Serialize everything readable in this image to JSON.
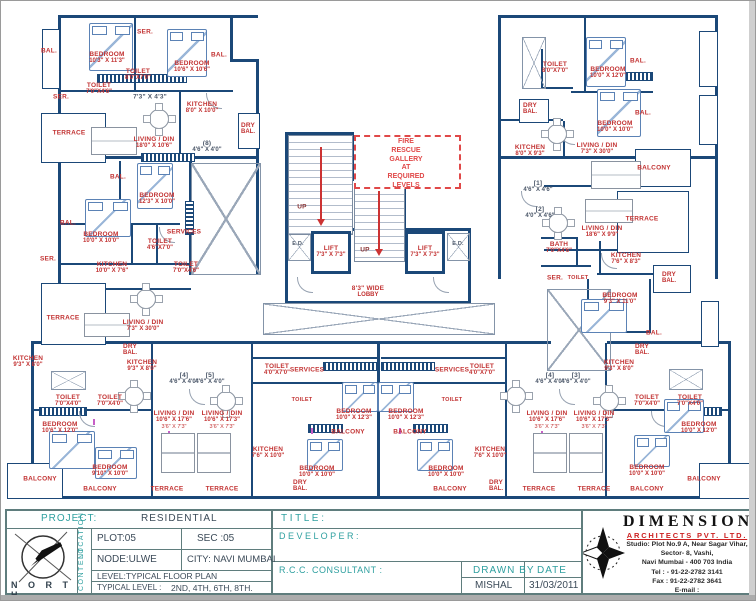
{
  "title_block": {
    "project_label": "PROJECT:",
    "project_value": "RESIDENTIAL",
    "plot": "PLOT:05",
    "sec": "SEC :05",
    "node": "NODE:ULWE",
    "city": "CITY: NAVI MUMBAI",
    "level_label": "LEVEL:",
    "level_value": "TYPICAL FLOOR PLAN",
    "typical_label": "TYPICAL LEVEL :",
    "typical_value": "2ND, 4TH, 6TH, 8TH.",
    "location_strip": "LOCATION",
    "content_strip": "CONTENT",
    "north_label": "N O R T H",
    "title_label": "T I T L E :",
    "developer_label": "D E V E L O P E R :",
    "rcc_label": "R.C.C. CONSULTANT :",
    "drawn_by_label": "DRAWN BY",
    "drawn_by_value": "MISHAL",
    "date_label": "DATE",
    "date_value": "31/03/2011"
  },
  "company": {
    "name": "DIMENSIONS",
    "subtitle": "ARCHITECTS PVT. LTD.",
    "address_lines": [
      "Studio: Plot No.9 A, Near Sagar Vihar,",
      "Sector- 8, Vashi,",
      "Navi Mumbai - 400 703 India",
      "Tel : - 91-22-2782 3141",
      "Fax : 91-22-2782 3641",
      "E-mail : info@dimensionsarchitect.co.in",
      "Website : dimensionsarchitect.co.in"
    ]
  },
  "plan": {
    "fire_rescue": "FIRE\nRESCUE\nGALLERY\nAT\nREQUIRED\nLEVELS",
    "colors": {
      "wall": "#1b4878",
      "label_red": "#c23232",
      "dashed_red": "#e04848"
    },
    "labels": [
      {
        "t": "BAL.",
        "x": 48,
        "y": 50
      },
      {
        "t": "BEDROOM",
        "d": "10'3\" X 11'3\"",
        "x": 106,
        "y": 57
      },
      {
        "t": "SER.",
        "x": 144,
        "y": 31
      },
      {
        "t": "TOILET",
        "d": "8'0\"X7'0\"",
        "x": 137,
        "y": 74
      },
      {
        "t": "BEDROOM",
        "d": "10'6\" X 10'6\"",
        "x": 191,
        "y": 66
      },
      {
        "t": "BAL.",
        "x": 218,
        "y": 54
      },
      {
        "t": "SER.",
        "x": 60,
        "y": 96
      },
      {
        "t": "TOILET",
        "d": "7'0\"X4'6\"",
        "x": 98,
        "y": 88
      },
      {
        "t": "7'3\" X 4'3\"",
        "x": 149,
        "y": 96,
        "c": "dark"
      },
      {
        "t": "KITCHEN",
        "d": "8'0\" X 10'0\"",
        "x": 201,
        "y": 107
      },
      {
        "t": "DRY",
        "d": "BAL.",
        "x": 247,
        "y": 128
      },
      {
        "t": "TERRACE",
        "x": 68,
        "y": 132
      },
      {
        "t": "LIVING / DIN",
        "d": "18'0\" X 10'6\"",
        "x": 153,
        "y": 142
      },
      {
        "t": "(8)",
        "d": "4'6\" X 4'0\"",
        "x": 206,
        "y": 146,
        "c": "dark"
      },
      {
        "t": "BAL.",
        "x": 117,
        "y": 176
      },
      {
        "t": "BEDROOM",
        "d": "12'3\" X 10'0\"",
        "x": 156,
        "y": 198
      },
      {
        "t": "BAL.",
        "x": 67,
        "y": 222
      },
      {
        "t": "BEDROOM",
        "d": "10'0\" X 10'0\"",
        "x": 100,
        "y": 237
      },
      {
        "t": "SERVICES",
        "x": 183,
        "y": 231
      },
      {
        "t": "TOILET",
        "d": "4'6\"X7'0\"",
        "x": 159,
        "y": 244
      },
      {
        "t": "TOILET",
        "d": "7'0\"X4'6\"",
        "x": 185,
        "y": 267
      },
      {
        "t": "KITCHEN",
        "d": "10'0\" X 7'6\"",
        "x": 111,
        "y": 267
      },
      {
        "t": "SER.",
        "x": 47,
        "y": 258
      },
      {
        "t": "TERRACE",
        "x": 62,
        "y": 317
      },
      {
        "t": "LIVING / DIN",
        "d": "7'3\" X 30'0\"",
        "x": 142,
        "y": 325
      },
      {
        "t": "UP",
        "x": 301,
        "y": 206,
        "c": "up"
      },
      {
        "t": "UP",
        "x": 364,
        "y": 249,
        "c": "up"
      },
      {
        "t": "E.D.",
        "x": 297,
        "y": 243,
        "c": "dark",
        "fs": 5.5
      },
      {
        "t": "LIFT",
        "d": "7'3\" X 7'3\"",
        "x": 330,
        "y": 251
      },
      {
        "t": "LIFT",
        "d": "7'3\" X 7'3\"",
        "x": 424,
        "y": 251
      },
      {
        "t": "E.D.",
        "x": 457,
        "y": 243,
        "c": "dark",
        "fs": 5.5
      },
      {
        "t": "8'3\" WIDE",
        "d": "LOBBY",
        "x": 367,
        "y": 291
      },
      {
        "t": "TOILET",
        "d": "8'0\"X7'0\"",
        "x": 554,
        "y": 67
      },
      {
        "t": "BEDROOM",
        "d": "10'0\" X 12'0\"",
        "x": 607,
        "y": 72
      },
      {
        "t": "BAL.",
        "x": 637,
        "y": 60
      },
      {
        "t": "DRY",
        "d": "BAL.",
        "x": 529,
        "y": 108
      },
      {
        "t": "BEDROOM",
        "d": "10'0\" X 10'0\"",
        "x": 614,
        "y": 126
      },
      {
        "t": "BAL.",
        "x": 642,
        "y": 112
      },
      {
        "t": "KITCHEN",
        "d": "8'0\" X 9'3\"",
        "x": 529,
        "y": 150
      },
      {
        "t": "LIVING / DIN",
        "d": "7'3\" X 30'0\"",
        "x": 596,
        "y": 148
      },
      {
        "t": "BALCONY",
        "x": 653,
        "y": 167
      },
      {
        "t": "[1]",
        "d": "4'6\" X 4'6\"",
        "x": 537,
        "y": 186,
        "c": "dark"
      },
      {
        "t": "[2]",
        "d": "4'0\" X 4'6\"",
        "x": 539,
        "y": 212,
        "c": "dark"
      },
      {
        "t": "TERRACE",
        "x": 641,
        "y": 218
      },
      {
        "t": "LIVING / DIN",
        "d": "18'6\" X 9'9\"",
        "x": 601,
        "y": 231
      },
      {
        "t": "BATH",
        "d": "7'0\"X4'6\"",
        "x": 558,
        "y": 247
      },
      {
        "t": "KITCHEN",
        "d": "7'6\" X 8'3\"",
        "x": 625,
        "y": 258
      },
      {
        "t": "SER.",
        "x": 554,
        "y": 277
      },
      {
        "t": "TOILET",
        "x": 577,
        "y": 277,
        "fs": 5.5
      },
      {
        "t": "DRY",
        "d": "BAL.",
        "x": 668,
        "y": 277
      },
      {
        "t": "BEDROOM",
        "d": "9'3\" X 11'0\"",
        "x": 619,
        "y": 298
      },
      {
        "t": "BAL.",
        "x": 653,
        "y": 332
      },
      {
        "t": "KITCHEN",
        "d": "9'3\" X 8'0\"",
        "x": 27,
        "y": 361
      },
      {
        "t": "DRY",
        "d": "BAL.",
        "x": 129,
        "y": 349
      },
      {
        "t": "KITCHEN",
        "d": "9'3\" X 8'0\"",
        "x": 141,
        "y": 365
      },
      {
        "t": "[4]",
        "d": "4'6\" X 4'0\"",
        "x": 183,
        "y": 378,
        "c": "dark"
      },
      {
        "t": "[5]",
        "d": "4'6\" X 4'0\"",
        "x": 209,
        "y": 378,
        "c": "dark"
      },
      {
        "t": "TOILET",
        "d": "7'0\"X4'0\"",
        "x": 67,
        "y": 400
      },
      {
        "t": "TOILET",
        "d": "7'0\"X4'0\"",
        "x": 109,
        "y": 400
      },
      {
        "t": "BEDROOM",
        "d": "10'6\" X 12'0\"",
        "x": 59,
        "y": 427
      },
      {
        "t": "BEDROOM",
        "d": "9'10\" X 10'0\"",
        "x": 109,
        "y": 470
      },
      {
        "t": "BALCONY",
        "x": 39,
        "y": 478
      },
      {
        "t": "BALCONY",
        "x": 99,
        "y": 488
      },
      {
        "t": "LIVING / DIN",
        "d": "10'6\" X 17'6\"",
        "d2": "3'6\" X 7'3\"",
        "x": 173,
        "y": 419
      },
      {
        "t": "LIVING / DIN",
        "d": "10'6\" X 17'3\"",
        "d2": "3'6\" X 7'3\"",
        "x": 221,
        "y": 419
      },
      {
        "t": "TERRACE",
        "x": 166,
        "y": 488
      },
      {
        "t": "TERRACE",
        "x": 221,
        "y": 488
      },
      {
        "t": "KITCHEN",
        "d": "7'6\" X 10'0\"",
        "x": 267,
        "y": 452
      },
      {
        "t": "DRY",
        "d": "BAL.",
        "x": 299,
        "y": 485
      },
      {
        "t": "BEDROOM",
        "d": "10'0\" X 10'0\"",
        "x": 316,
        "y": 471
      },
      {
        "t": "BALCONY",
        "x": 347,
        "y": 431
      },
      {
        "t": "BALCONY",
        "x": 409,
        "y": 431
      },
      {
        "t": "BEDROOM",
        "d": "10'0\" X 12'3\"",
        "x": 353,
        "y": 414
      },
      {
        "t": "BEDROOM",
        "d": "10'0\" X 12'3\"",
        "x": 405,
        "y": 414
      },
      {
        "t": "SERVICES",
        "x": 306,
        "y": 369
      },
      {
        "t": "SERVICES",
        "x": 451,
        "y": 369
      },
      {
        "t": "TOILET",
        "d": "4'0\"X7'0\"",
        "x": 276,
        "y": 369
      },
      {
        "t": "TOILET",
        "d": "4'0\"X7'0\"",
        "x": 481,
        "y": 369
      },
      {
        "t": "TOILET",
        "x": 301,
        "y": 399,
        "fs": 5.5
      },
      {
        "t": "TOILET",
        "x": 451,
        "y": 399,
        "fs": 5.5
      },
      {
        "t": "BEDROOM",
        "d": "10'0\" X 10'0\"",
        "x": 445,
        "y": 471
      },
      {
        "t": "BALCONY",
        "x": 449,
        "y": 488
      },
      {
        "t": "KITCHEN",
        "d": "7'6\" X 10'0\"",
        "x": 489,
        "y": 452
      },
      {
        "t": "DRY",
        "d": "BAL.",
        "x": 495,
        "y": 485
      },
      {
        "t": "DRY",
        "d": "BAL.",
        "x": 641,
        "y": 349
      },
      {
        "t": "KITCHEN",
        "d": "9'3\" X 8'0\"",
        "x": 618,
        "y": 365
      },
      {
        "t": "[4]",
        "d": "4'6\" X 4'0\"",
        "x": 549,
        "y": 378,
        "c": "dark"
      },
      {
        "t": "[3]",
        "d": "4'6\" X 4'0\"",
        "x": 575,
        "y": 378,
        "c": "dark"
      },
      {
        "t": "LIVING / DIN",
        "d": "10'6\" X 17'6\"",
        "d2": "3'6\" X 7'3\"",
        "x": 546,
        "y": 419
      },
      {
        "t": "LIVING / DIN",
        "d": "10'6\" X 17'3\"",
        "d2": "3'6\" X 7'3\"",
        "x": 593,
        "y": 419
      },
      {
        "t": "TOILET",
        "d": "7'0\"X4'0\"",
        "x": 646,
        "y": 400
      },
      {
        "t": "TOILET",
        "d": "7'0\"X4'0\"",
        "x": 689,
        "y": 400
      },
      {
        "t": "BEDROOM",
        "d": "10'0\" X 12'0\"",
        "x": 698,
        "y": 427
      },
      {
        "t": "BEDROOM",
        "d": "10'0\" X 10'0\"",
        "x": 646,
        "y": 470
      },
      {
        "t": "TERRACE",
        "x": 538,
        "y": 488
      },
      {
        "t": "TERRACE",
        "x": 593,
        "y": 488
      },
      {
        "t": "BALCONY",
        "x": 646,
        "y": 488
      },
      {
        "t": "BALCONY",
        "x": 703,
        "y": 478
      }
    ]
  }
}
